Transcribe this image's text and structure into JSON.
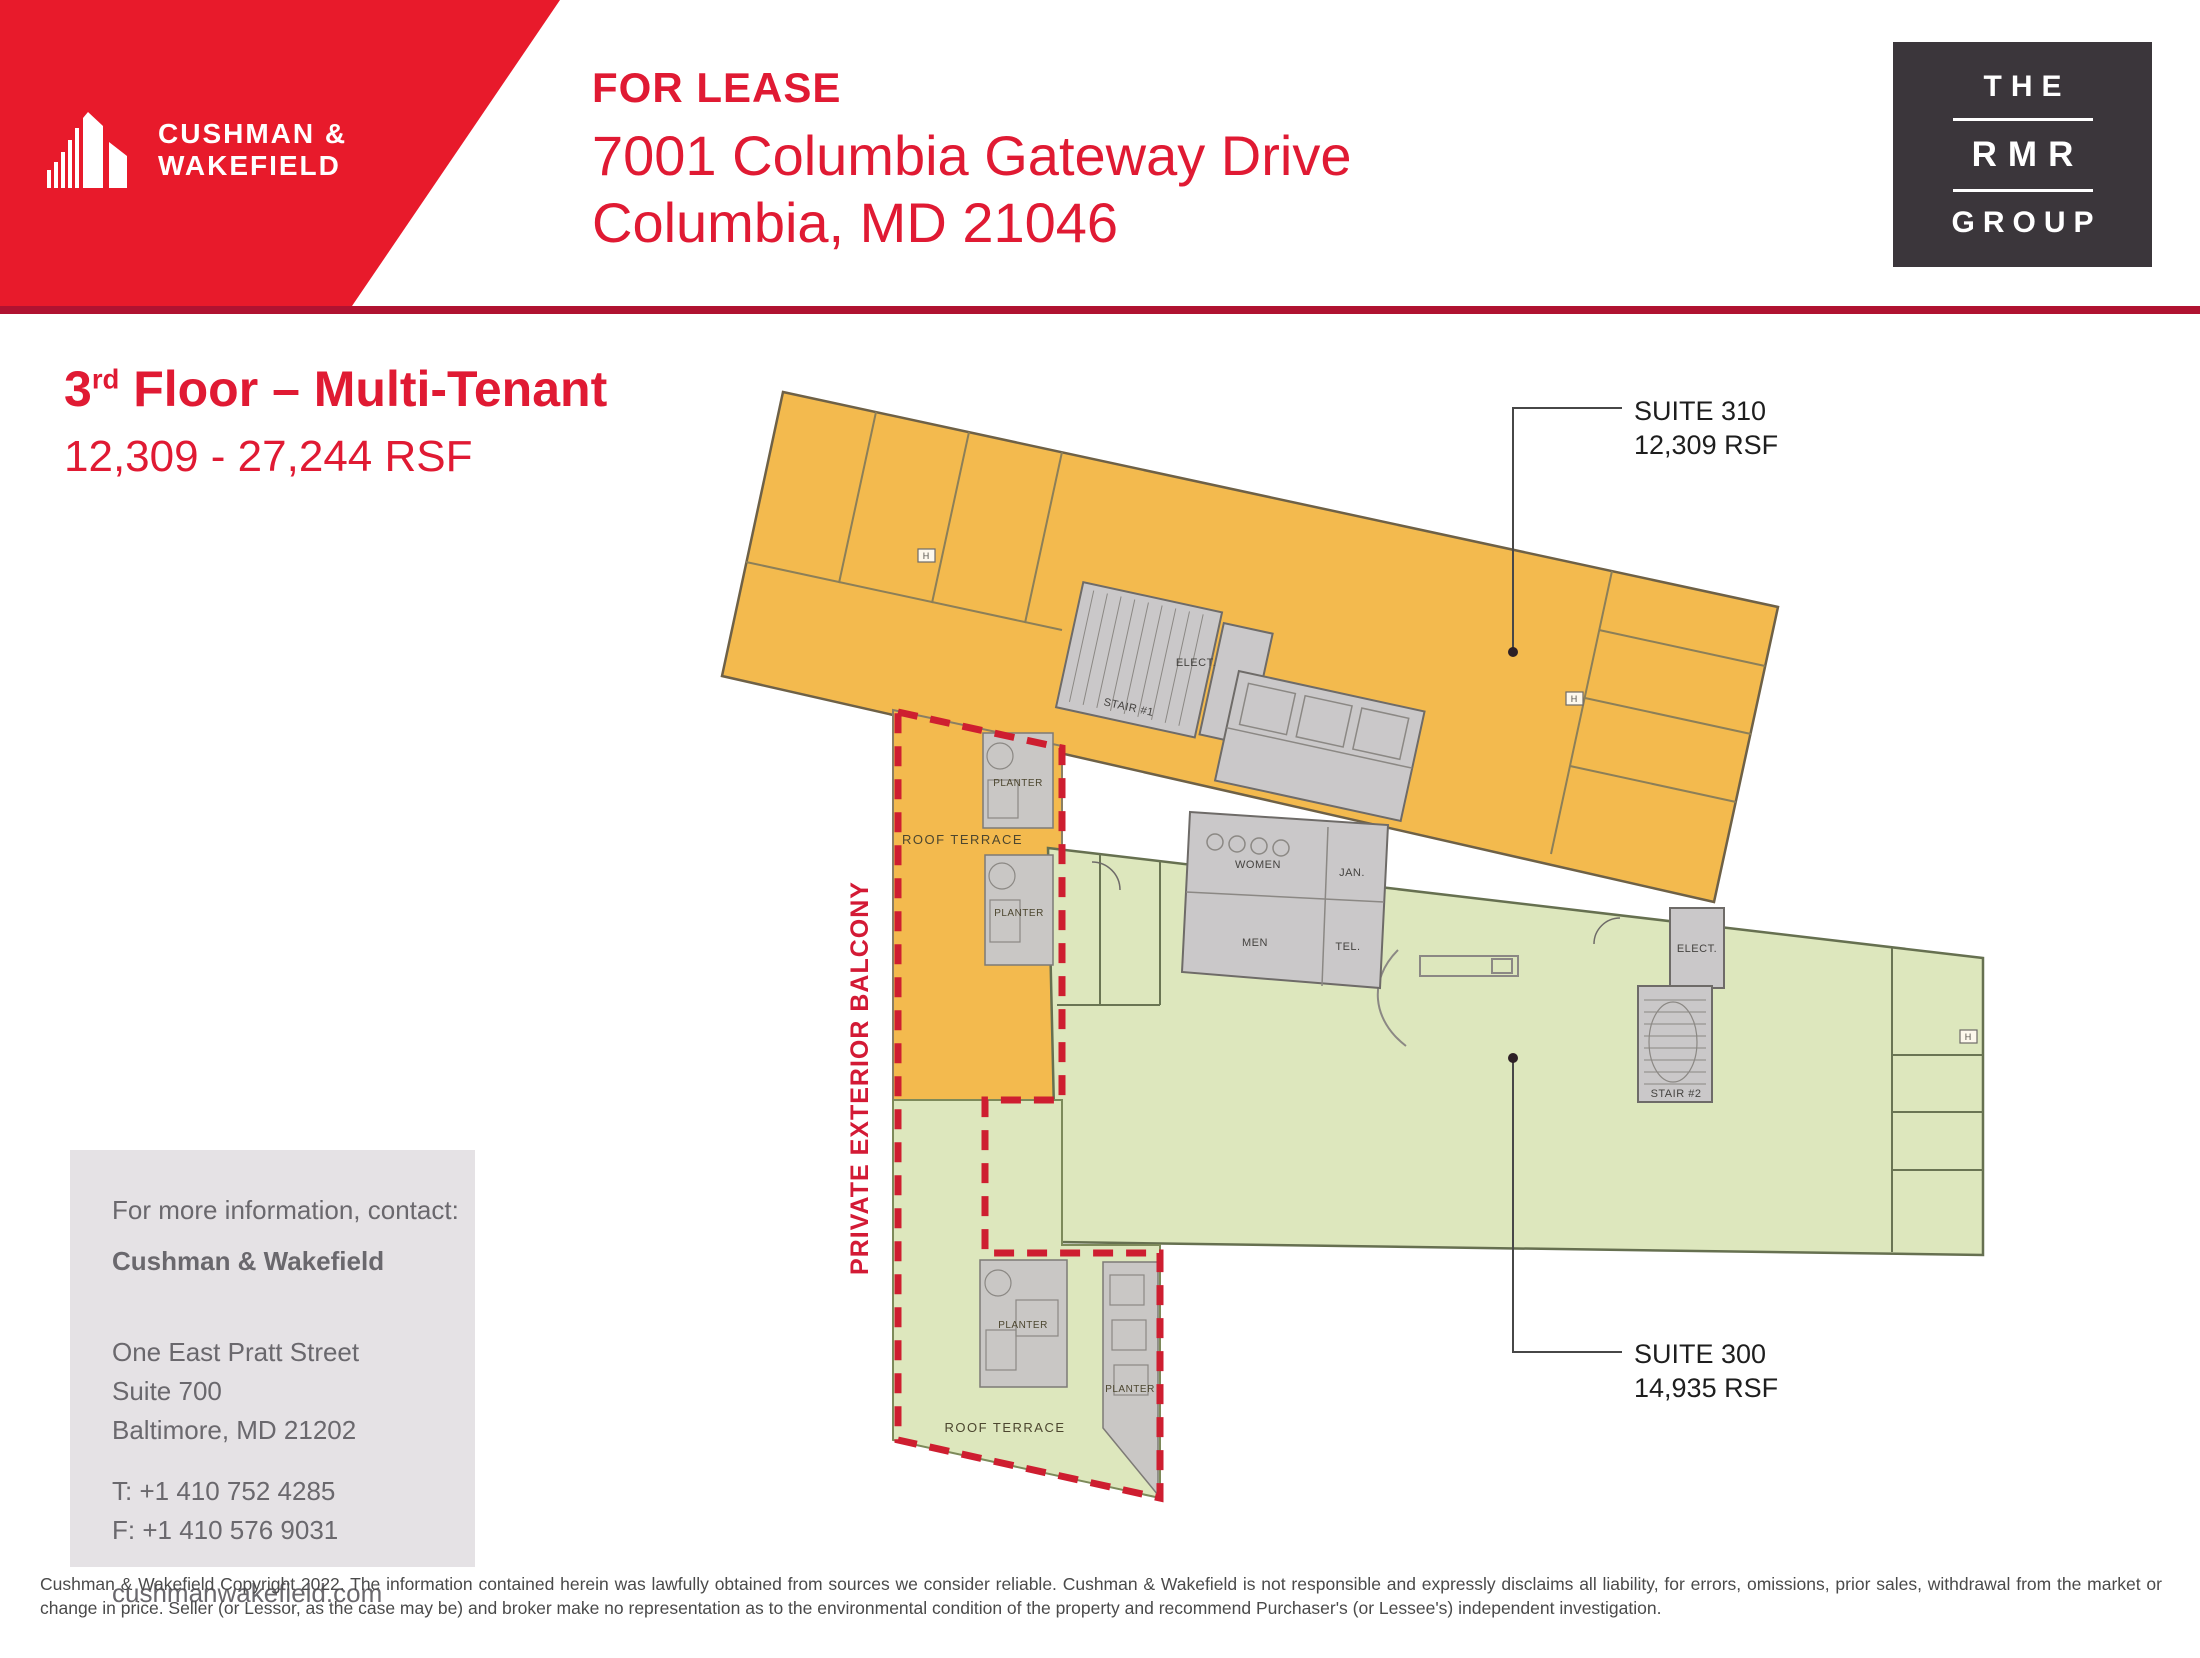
{
  "header": {
    "cw_line1": "CUSHMAN &",
    "cw_line2": "WAKEFIELD",
    "for_lease": "FOR LEASE",
    "address1": "7001 Columbia Gateway Drive",
    "address2": "Columbia, MD 21046",
    "rmr_the": "THE",
    "rmr_rmr": "RMR",
    "rmr_group": "GROUP"
  },
  "title": {
    "floor_num": "3",
    "floor_sup": "rd",
    "floor_rest": " Floor – Multi-Tenant",
    "rsf_range": "12,309 - 27,244 RSF"
  },
  "plan": {
    "suite310_name": "SUITE 310",
    "suite310_rsf": "12,309 RSF",
    "suite300_name": "SUITE 300",
    "suite300_rsf": "14,935 RSF",
    "balcony": "PRIVATE EXTERIOR BALCONY",
    "stair1": "STAIR #1",
    "stair2": "STAIR #2",
    "elect": "ELECT.",
    "women": "WOMEN",
    "men": "MEN",
    "jan": "JAN.",
    "tel": "TEL.",
    "roof_terrace": "ROOF TERRACE",
    "planter": "PLANTER",
    "h_marker": "H"
  },
  "contact": {
    "intro": "For more information, contact:",
    "name": "Cushman & Wakefield",
    "addr1": "One East Pratt Street",
    "addr2": "Suite 700",
    "addr3": "Baltimore, MD 21202",
    "tel": "T: +1 410 752 4285",
    "fax": "F: +1 410 576 9031",
    "web": "cushmanwakefield.com"
  },
  "disclaimer": {
    "text": "Cushman & Wakefield Copyright 2022. The information contained herein was lawfully obtained from sources we consider reliable. Cushman & Wakefield is not responsible and expressly disclaims all liability, for errors, omissions, prior sales,  withdrawal from the market or change in price. Seller (or Lessor, as the case may be) and broker make no representation as to the environmental condition of the property and recommend Purchaser's (or Lessee's) independent investigation."
  },
  "colors": {
    "banner_red": "#E81A2B",
    "text_red": "#E01A33",
    "rule_red": "#B01231",
    "rmr_charcoal": "#3B363B",
    "suite310_orange": "#F3BA4E",
    "suite300_green": "#DDE7BD",
    "core_gray": "#CAC8C9",
    "dashed_red": "#CE1E30",
    "contact_bg": "#E5E2E5"
  }
}
